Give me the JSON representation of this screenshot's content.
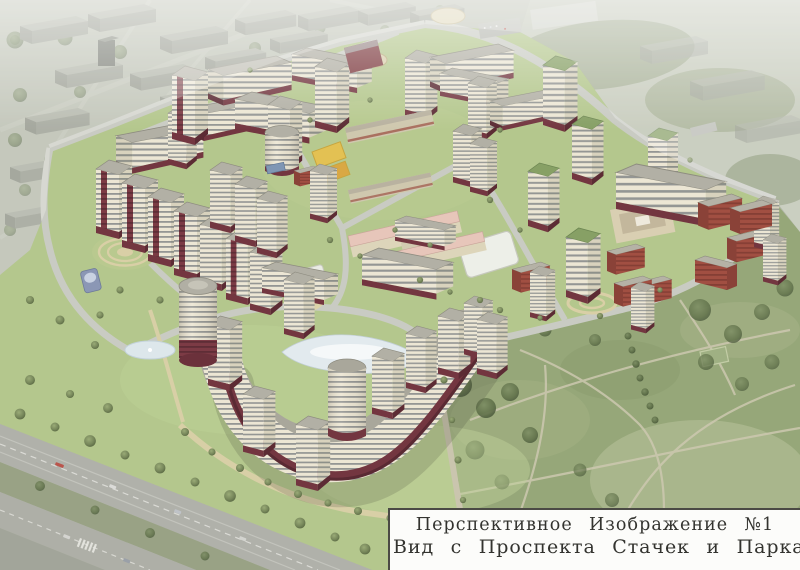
{
  "caption": {
    "line1": "Перспективное Изображение №1",
    "line2": "Вид с Проспекта Стачек и Парка “Александрино"
  },
  "palette": {
    "facade_cream": "#ece6d4",
    "facade_side": "#d8d2bd",
    "window_band": "#767b7e",
    "base_maroon": "#733640",
    "roof_gray": "#b2b0a5",
    "roof_green": "#87a065",
    "brick_red": "#a14f42",
    "lawn_green": "#b4c78d",
    "park_green": "#96a779",
    "road_gray": "#a7a8a0",
    "path_beige": "#dbd2a9",
    "court_yellow": "#e3c153",
    "pond_white": "#e2eaee",
    "photo_gray": "#b0b5a6",
    "caption_bg": "#fcfcfa",
    "caption_border": "#4b4a45",
    "caption_text": "#33332f"
  }
}
